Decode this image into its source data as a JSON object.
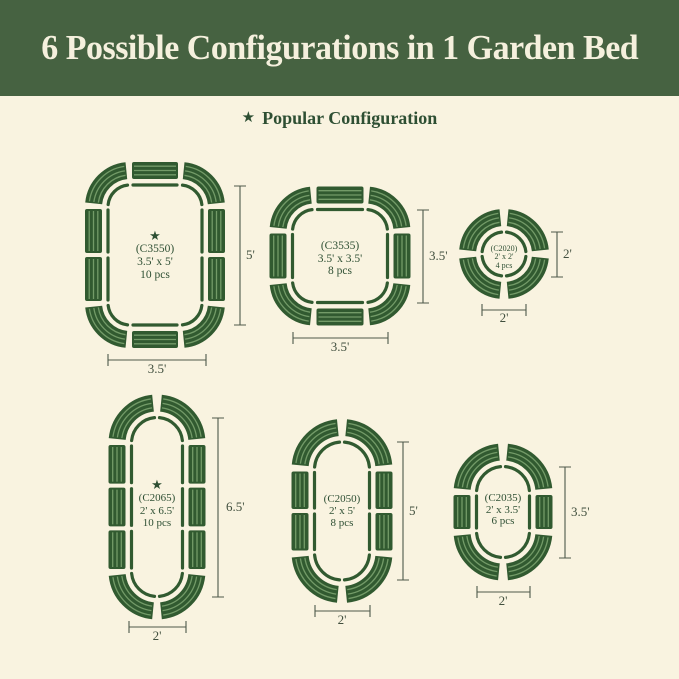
{
  "header": {
    "title": "6 Possible Configurations in 1 Garden Bed"
  },
  "legend": {
    "star": "★",
    "label": "Popular Configuration"
  },
  "configs": [
    {
      "model": "(C3550)",
      "size": "3.5' x 5'",
      "pieces": "10 pcs",
      "popular": true,
      "height_label": "5'",
      "width_label": "3.5'"
    },
    {
      "model": "(C3535)",
      "size": "3.5' x 3.5'",
      "pieces": "8 pcs",
      "popular": false,
      "height_label": "3.5'",
      "width_label": "3.5'"
    },
    {
      "model": "(C2020)",
      "size": "2' x 2'",
      "pieces": "4 pcs",
      "popular": false,
      "height_label": "2'",
      "width_label": "2'"
    },
    {
      "model": "(C2065)",
      "size": "2' x 6.5'",
      "pieces": "10 pcs",
      "popular": true,
      "height_label": "6.5'",
      "width_label": "2'"
    },
    {
      "model": "(C2050)",
      "size": "2' x 5'",
      "pieces": "8 pcs",
      "popular": false,
      "height_label": "5'",
      "width_label": "2'"
    },
    {
      "model": "(C2035)",
      "size": "2' x 3.5'",
      "pieces": "6 pcs",
      "popular": false,
      "height_label": "3.5'",
      "width_label": "2'"
    }
  ],
  "colors": {
    "header": "#466241",
    "cream": "#f9f3e0",
    "title": "#f5f0dd",
    "green-text": "#2e4f33",
    "bed": "#315a30",
    "stripe": "#85ab77",
    "dim": "#4e584a",
    "dim-text": "#414f3e"
  }
}
